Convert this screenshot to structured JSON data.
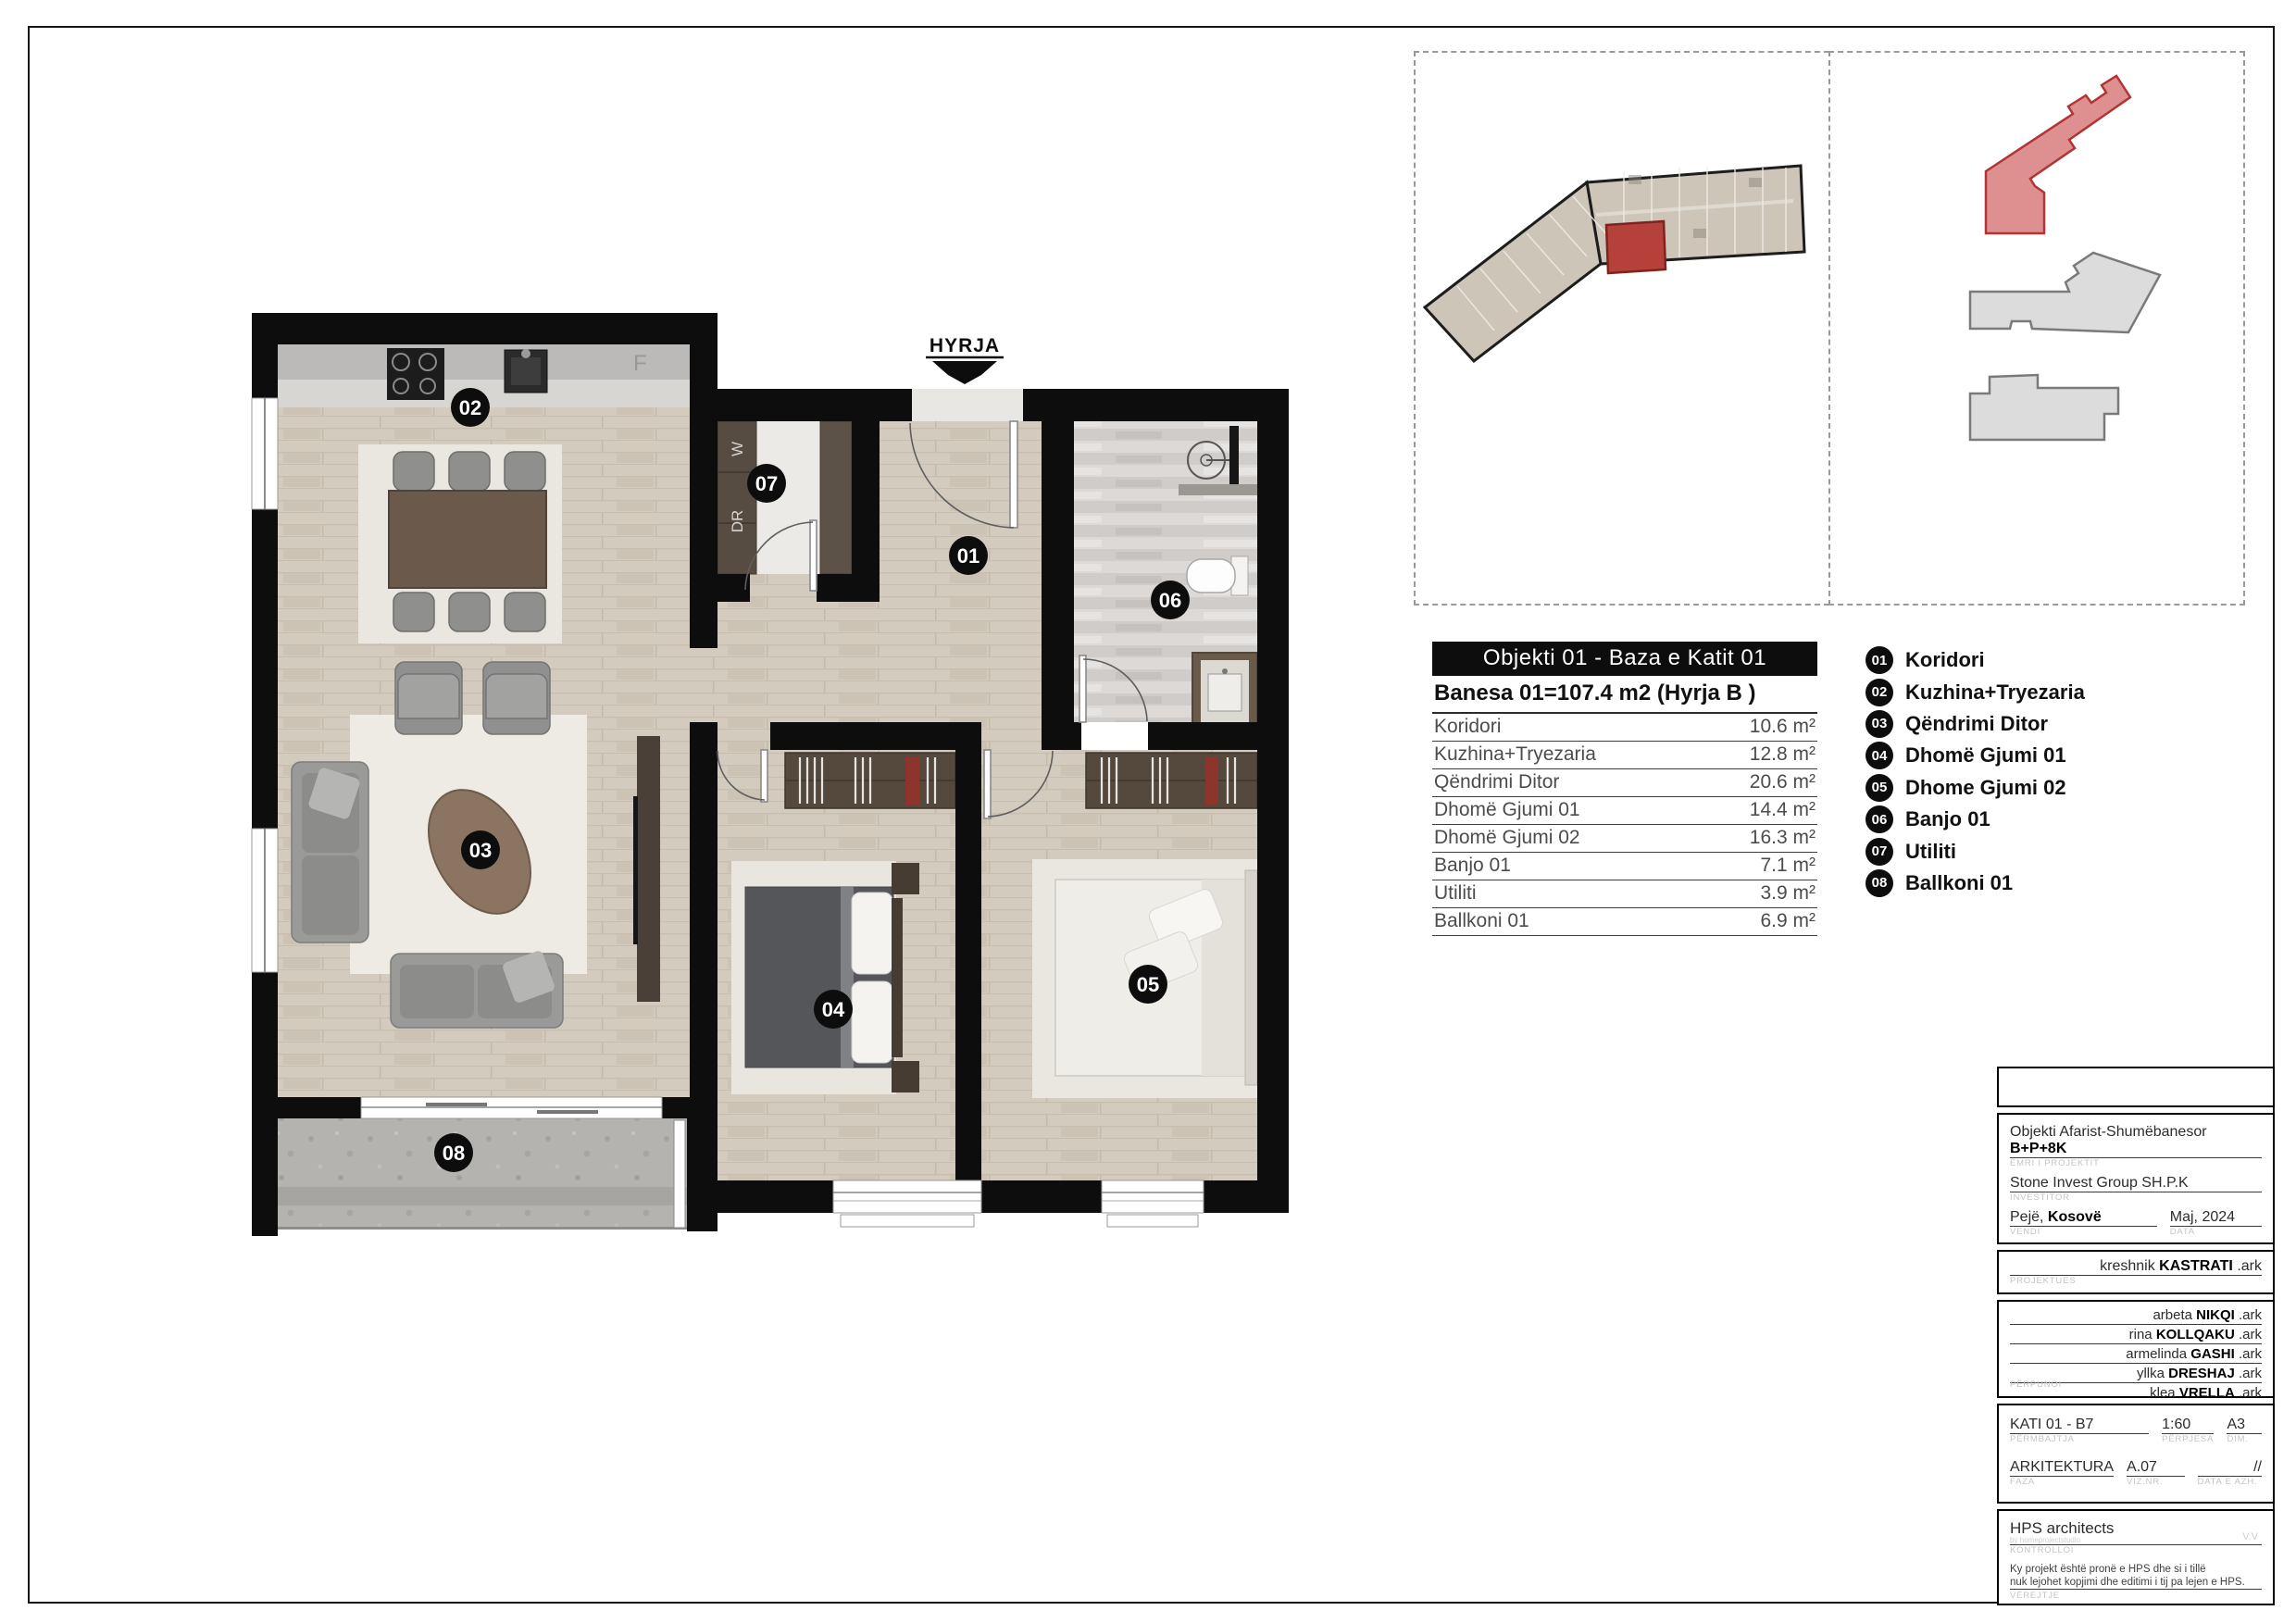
{
  "plan": {
    "entrance_label": "HYRJA",
    "fridge_label": "F",
    "washer_label": "W",
    "dryer_label": "DR",
    "badges": [
      "01",
      "02",
      "03",
      "04",
      "05",
      "06",
      "07",
      "08"
    ]
  },
  "area_table": {
    "title": "Objekti 01 - Baza e Katit 01",
    "subtitle": "Banesa 01=107.4 m2 (Hyrja B )",
    "rows": [
      {
        "label": "Koridori",
        "value": "10.6 m²"
      },
      {
        "label": "Kuzhina+Tryezaria",
        "value": "12.8 m²"
      },
      {
        "label": "Qëndrimi Ditor",
        "value": "20.6 m²"
      },
      {
        "label": "Dhomë Gjumi 01",
        "value": "14.4 m²"
      },
      {
        "label": "Dhomë Gjumi 02",
        "value": "16.3 m²"
      },
      {
        "label": "Banjo 01",
        "value": "7.1 m²"
      },
      {
        "label": "Utiliti",
        "value": "3.9 m²"
      },
      {
        "label": "Ballkoni 01",
        "value": "6.9 m²"
      }
    ]
  },
  "legend": {
    "items": [
      {
        "num": "01",
        "label": "Koridori"
      },
      {
        "num": "02",
        "label": "Kuzhina+Tryezaria"
      },
      {
        "num": "03",
        "label": "Qëndrimi Ditor"
      },
      {
        "num": "04",
        "label": "Dhomë Gjumi 01"
      },
      {
        "num": "05",
        "label": "Dhome Gjumi 02"
      },
      {
        "num": "06",
        "label": "Banjo 01"
      },
      {
        "num": "07",
        "label": "Utiliti"
      },
      {
        "num": "08",
        "label": "Ballkoni 01"
      }
    ]
  },
  "title_block": {
    "project": {
      "text": "Objekti Afarist-Shumëbanesor ",
      "bold": "B+P+8K",
      "label": "EMRI I PROJEKTIT"
    },
    "investor": {
      "text": "Stone Invest Group SH.P.K",
      "label": "INVESTITOR"
    },
    "place": {
      "text": "Pejë, ",
      "bold": "Kosovë",
      "label": "VENDI"
    },
    "date": {
      "text": "Maj, 2024",
      "label": "DATA"
    },
    "designer": {
      "first": "kreshnik ",
      "last": "KASTRATI",
      "suffix": " .ark",
      "label": "PROJEKTUES"
    },
    "team_label": "PËRPUNOI",
    "team_suffix": " .ark",
    "team": [
      {
        "first": "arbeta ",
        "last": "NIKQI"
      },
      {
        "first": "rina ",
        "last": "KOLLQAKU"
      },
      {
        "first": "armelinda ",
        "last": "GASHI"
      },
      {
        "first": "yllka ",
        "last": "DRESHAJ"
      },
      {
        "first": "klea ",
        "last": "VRELLA"
      }
    ],
    "content": {
      "text": "KATI 01 - B7",
      "label": "PËRMBAJTJA"
    },
    "scale": {
      "text": "1:60",
      "label": "PËRPJESA"
    },
    "size": {
      "text": "A3",
      "label": "DIM."
    },
    "phase": {
      "text": "ARKITEKTURA",
      "label": "FAZA"
    },
    "drawing_no": {
      "text": "A.07",
      "label": "VIZ.NR."
    },
    "revision": {
      "text": "//",
      "label": "DATA E AZH."
    },
    "control": {
      "text": "HPS architects",
      "sub": "by homeprojectstudio",
      "extra": "V.V",
      "label": "KONTROLLOI"
    },
    "note": {
      "line1": "Ky projekt është pronë e HPS dhe si i tillë",
      "line2": "nuk lejohet kopjimi dhe editimi i tij pa lejen e HPS.",
      "label": "VËREJTJE"
    }
  },
  "colors": {
    "highlight_red": "#b5413a",
    "wall_black": "#0d0d0d",
    "wood_floor": "#d3cbbd",
    "balcony_gray": "#b5b3b0"
  }
}
